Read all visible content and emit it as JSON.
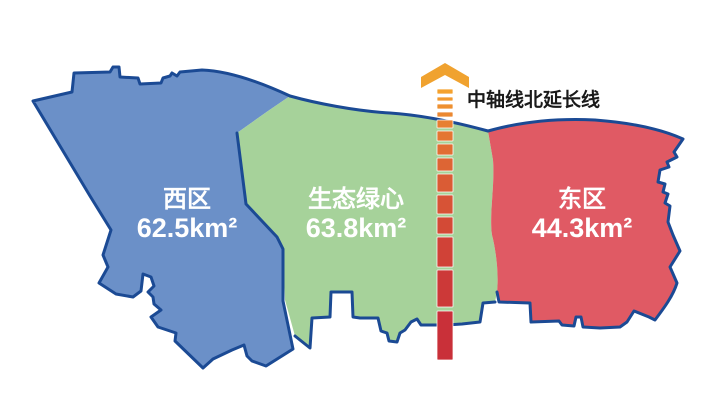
{
  "background": "#FFFFFF",
  "outline_color": "#1B4A94",
  "region_label_color": "#FFFFFF",
  "regions": [
    {
      "name": "西区",
      "area": "62.5km²",
      "fill": "#6B90C8"
    },
    {
      "name": "生态绿心",
      "area": "63.8km²",
      "fill": "#A6D29A"
    },
    {
      "name": "东区",
      "area": "44.3km²",
      "fill": "#E05A64"
    }
  ],
  "axis_line": {
    "label": "中轴线北延长线",
    "label_color": "#1A1A1A",
    "top_color": "#F5A22E",
    "bottom_color": "#C93039",
    "arrow_color": "#F0A22F"
  }
}
